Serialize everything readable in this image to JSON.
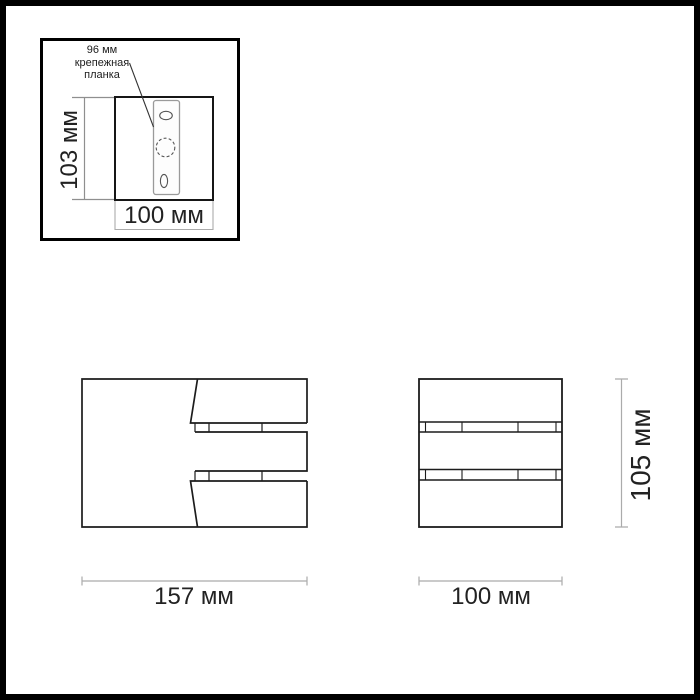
{
  "inset": {
    "callout": {
      "line1": "96 мм",
      "line2": "крепежная",
      "line3": "планка"
    },
    "plate_height_label": "103 мм",
    "plate_width_label": "100 мм"
  },
  "side_view": {
    "width_label": "157 мм"
  },
  "front_view": {
    "width_label": "100 мм",
    "height_label": "105 мм"
  },
  "colors": {
    "background": "#ffffff",
    "frame": "#000000",
    "linework": "#1c1c1c",
    "dimension_lines": "#ababab"
  }
}
